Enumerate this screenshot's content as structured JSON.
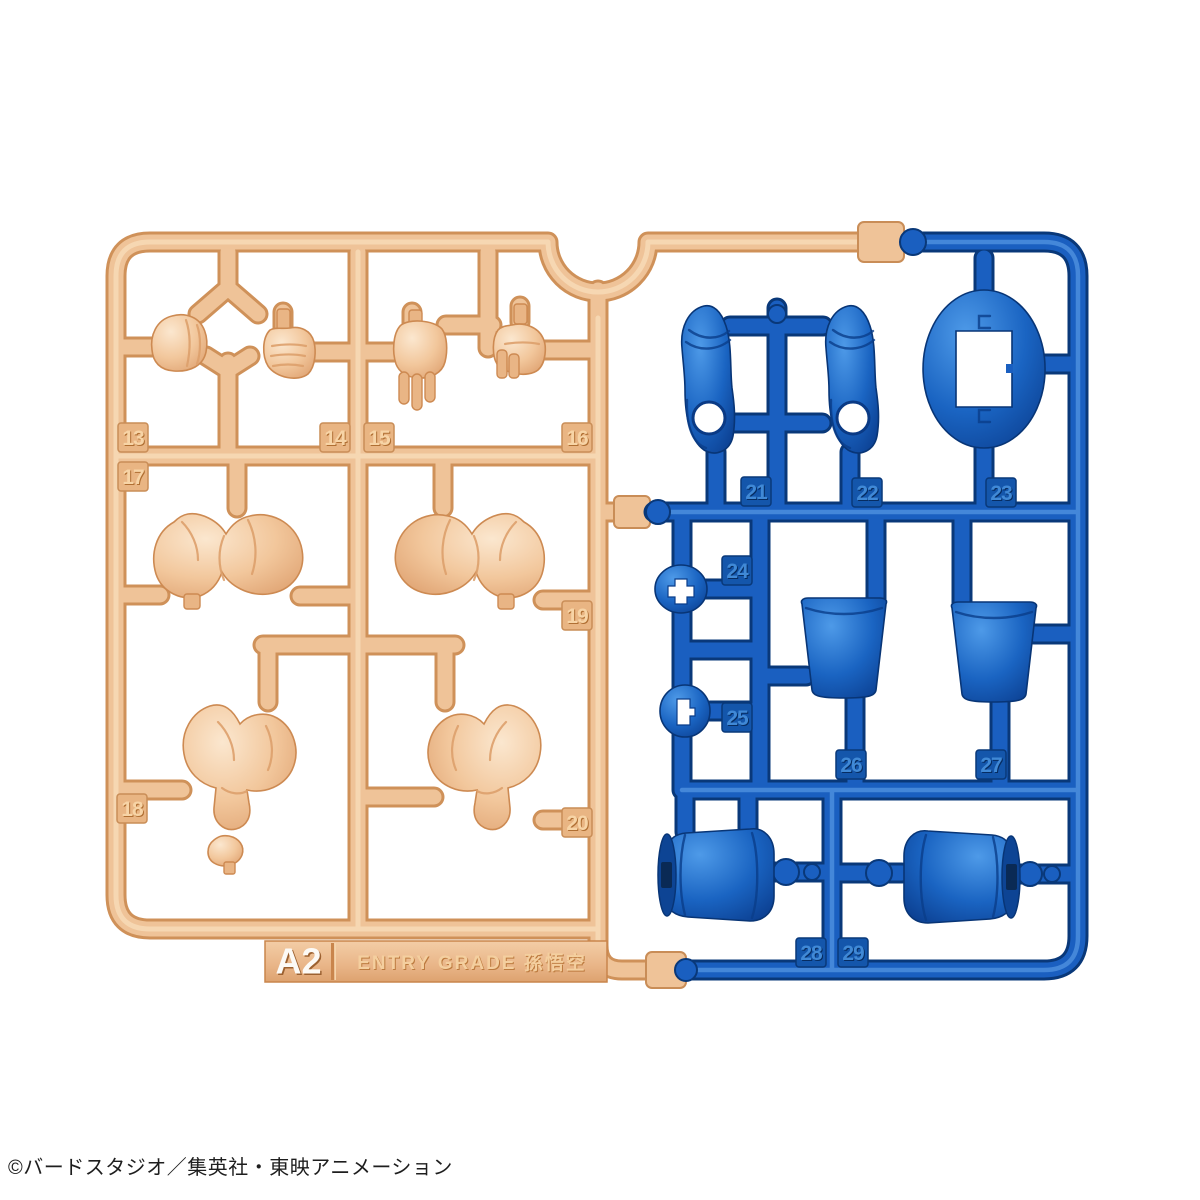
{
  "plate": {
    "runner_code": "A2",
    "kit_name": "ENTRY GRADE 孫悟空"
  },
  "footer": {
    "copyright": "©バードスタジオ／集英社・東映アニメーション"
  },
  "colors": {
    "flesh_plastic": "#efc398",
    "blue_plastic": "#1a5fc0",
    "background": "#ffffff"
  },
  "tags": {
    "13": "13",
    "14": "14",
    "15": "15",
    "16": "16",
    "17": "17",
    "18": "18",
    "19": "19",
    "20": "20",
    "21": "21",
    "22": "22",
    "23": "23",
    "24": "24",
    "25": "25",
    "26": "26",
    "27": "27",
    "28": "28",
    "29": "29"
  }
}
